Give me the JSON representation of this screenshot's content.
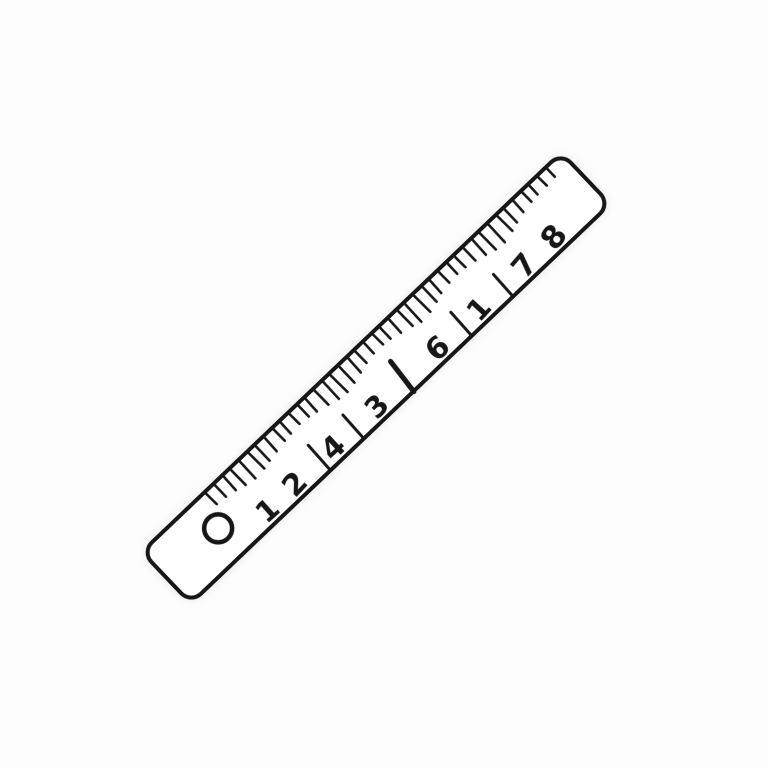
{
  "page": {
    "background_color": "#fdfdfd",
    "description_label": "ruler-illustration"
  },
  "ruler": {
    "stroke_color": "#171717",
    "fill_color": "#fefefe",
    "angle_deg": -43.6,
    "length_px": 584,
    "thickness_px": 76,
    "center": {
      "x": 376,
      "y": 378
    },
    "corner_radius": 14,
    "outline_stroke_width": 4,
    "hole": {
      "x": 74,
      "y": 38,
      "radius": 14,
      "stroke_width": 4.5
    },
    "edge_ticks": {
      "start_x": 90,
      "spacing": 11.45,
      "top_y": 4.5,
      "stroke_width": 2.6,
      "lengths": [
        15,
        16,
        18,
        21,
        23,
        22,
        20,
        18,
        16,
        15,
        14,
        15,
        17,
        20,
        23,
        24,
        22,
        19,
        16,
        14,
        14,
        15,
        18,
        21,
        24,
        23,
        20,
        17,
        15,
        14,
        15,
        17,
        20,
        23,
        24,
        21,
        18,
        15,
        13,
        12,
        12,
        11
      ]
    },
    "number_row": {
      "baseline_y": 69,
      "font_size": 30,
      "numbers": [
        {
          "label": "1",
          "x": 122,
          "tilt": 2,
          "size": 29
        },
        {
          "label": "2",
          "x": 160,
          "tilt": -3,
          "size": 30
        },
        {
          "label": "4",
          "x": 213,
          "tilt": 1,
          "size": 30
        },
        {
          "label": "3",
          "x": 273,
          "tilt": -2,
          "size": 29
        },
        {
          "label": "6",
          "x": 357,
          "tilt": 2,
          "size": 30
        },
        {
          "label": "1",
          "x": 414,
          "tilt": -4,
          "size": 29
        },
        {
          "label": "7",
          "x": 477,
          "tilt": -6,
          "size": 30
        },
        {
          "label": "8",
          "x": 518,
          "tilt": -8,
          "size": 31
        }
      ],
      "separators": [
        {
          "x": 196,
          "y1": 40,
          "y2": 72,
          "width": 3,
          "tilt": 2
        },
        {
          "x": 242,
          "y1": 42,
          "y2": 72,
          "width": 3,
          "tilt": 2
        },
        {
          "x": 312,
          "y1": 36,
          "y2": 74,
          "width": 5.2,
          "tilt": 6
        },
        {
          "x": 391,
          "y1": 42,
          "y2": 72,
          "width": 3,
          "tilt": 2
        },
        {
          "x": 448,
          "y1": 44,
          "y2": 72,
          "width": 3,
          "tilt": 2
        }
      ]
    }
  }
}
